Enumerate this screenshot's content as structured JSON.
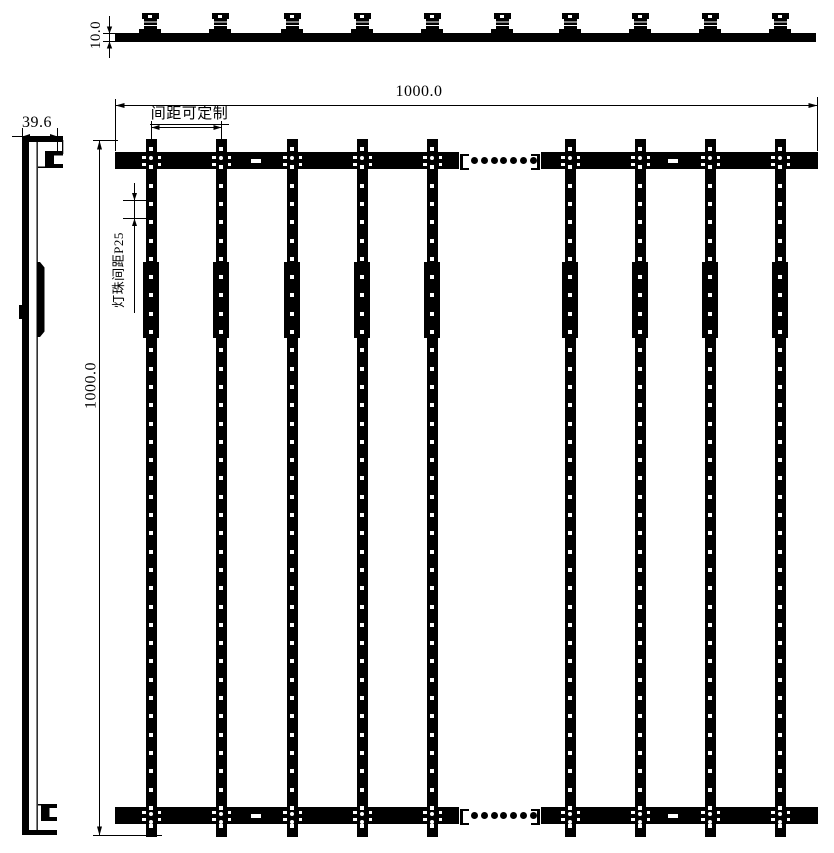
{
  "drawing": {
    "kind": "LED strip screen technical drawing",
    "views": {
      "top_view": "top profile with mounting clips",
      "side_view": "side profile",
      "front_view": "front elevation with vertical LED strips"
    },
    "colors": {
      "ink": "#000000",
      "background": "#ffffff"
    }
  },
  "labels": {
    "top_thickness": "10.0",
    "side_width": "39.6",
    "front_width": "1000.0",
    "front_height": "1000.0",
    "strip_spacing": "间距可定制",
    "led_pitch": "灯珠间距P25"
  },
  "geometry": {
    "strip_centers_px": [
      151,
      221,
      292,
      362,
      432,
      570,
      640,
      710,
      780
    ],
    "clip_centers_px": [
      150,
      220,
      292,
      362,
      432,
      502,
      570,
      640,
      710,
      780
    ],
    "visible_strip_count": 9,
    "clip_count": 10,
    "ellipsis_dots": 7,
    "led_hole_pitch_px": 18.3,
    "rail_slot_offsets_px": [
      136,
      553
    ]
  }
}
